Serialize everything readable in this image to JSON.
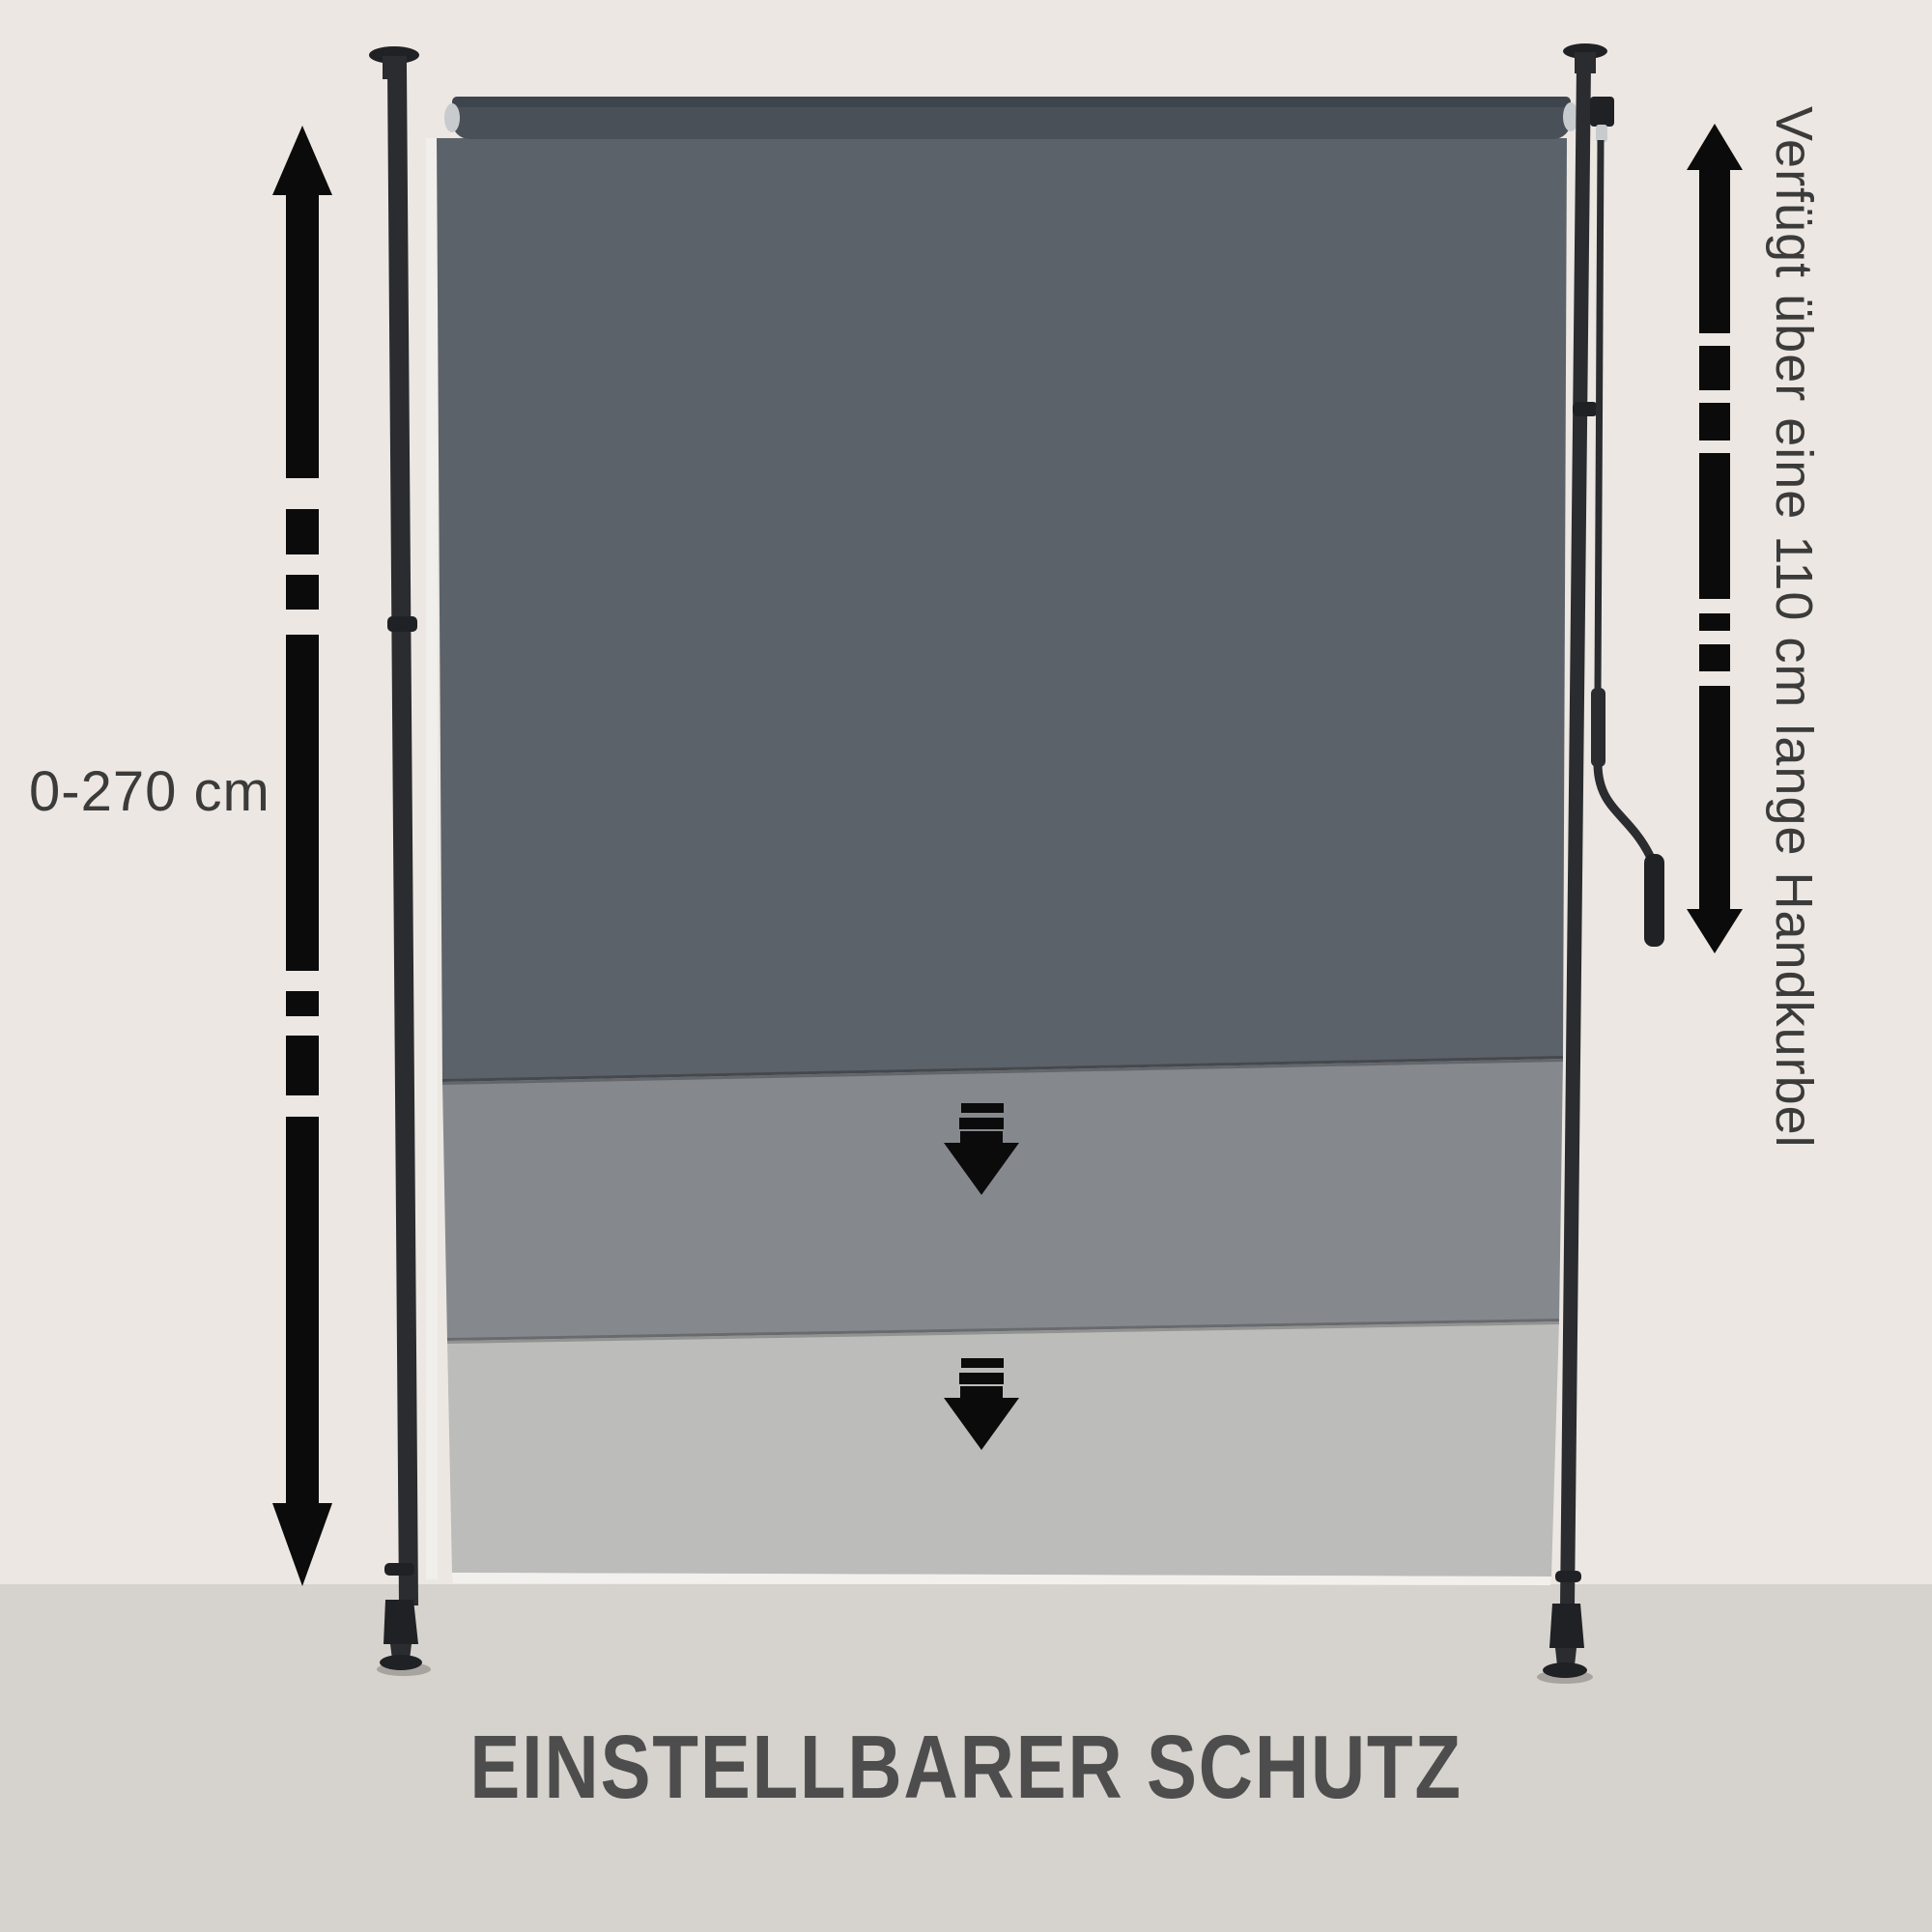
{
  "scene": {
    "title": "EINSTELLBARER SCHUTZ",
    "height_range_label": "0-270 cm",
    "crank_label": "Verfügt über eine 110 cm lange Handkurbel"
  },
  "product": {
    "type": "adjustable telescopic roller blind between two clamp poles",
    "extension_stages": 3
  },
  "icons": {
    "left_range_arrow": "double-headed-dashed-vertical-arrow-icon",
    "right_range_arrow": "double-headed-dashed-vertical-arrow-icon",
    "extend_step_arrow": "dashed-down-arrow-icon",
    "ceiling_mount": "ceiling-plate-icon",
    "floor_foot": "rubber-foot-icon",
    "crank": "hand-crank-icon"
  },
  "colors": {
    "wall": "#ECE7E2",
    "floor": "#D6D2CD",
    "fabric_dark": "#5C6269",
    "fabric_medium": "#85898E",
    "fabric_light": "#BCBCBA",
    "fabric_edge_light": "#F2F0ED",
    "roller_tube": "#4A5057",
    "roller_tube_top": "#3E444B",
    "pole": "#2A2C2F",
    "pole_dark": "#1F2124",
    "chrome": "#C7CBCE",
    "arrow": "#0B0B0B",
    "label_text": "#3B3B3B",
    "title_text": "#4D4D4D"
  }
}
